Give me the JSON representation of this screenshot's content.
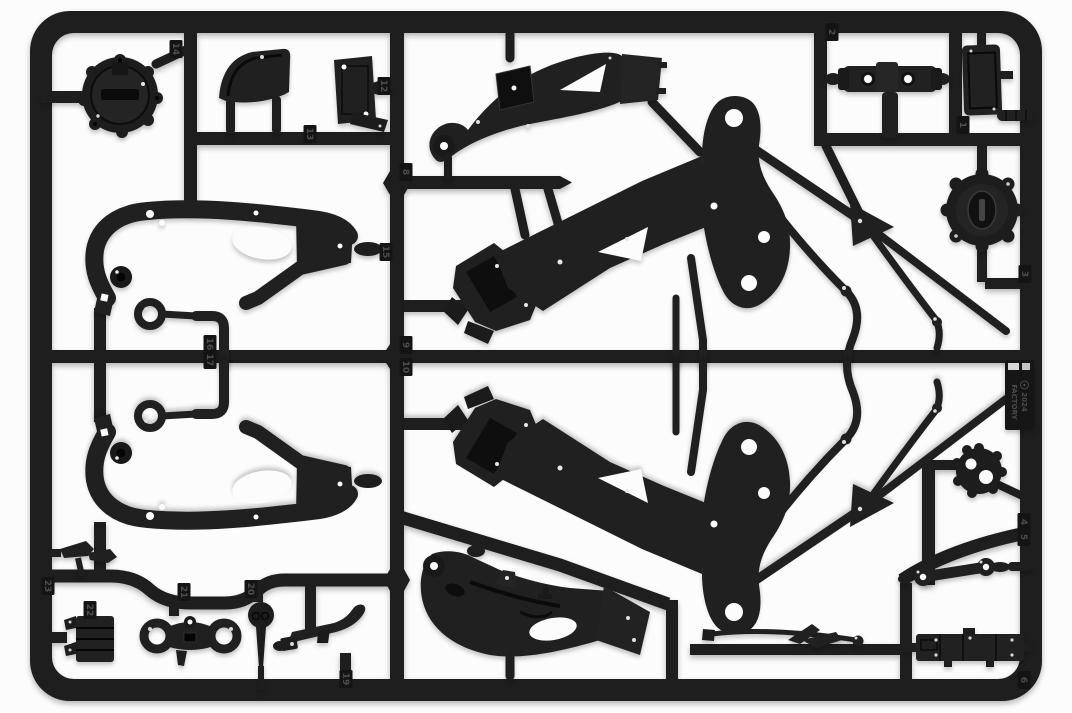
{
  "scene": {
    "type": "photograph",
    "subject": "Black injection-molded plastic model-kit sprue with motorcycle frame parts",
    "background_color": "#fcfcfc",
    "plastic_color": "#1e1e1e",
    "plastic_dark": "#0c0c0c",
    "plastic_highlight": "#3a3a3a"
  },
  "mold_tag": {
    "year": "2024",
    "brand": "FACTORY",
    "logo": "circled-monogram"
  },
  "gate_numbers": [
    {
      "label": "14",
      "x": 176,
      "y": 49
    },
    {
      "label": "13",
      "x": 310,
      "y": 134
    },
    {
      "label": "12",
      "x": 384,
      "y": 86
    },
    {
      "label": "2",
      "x": 832,
      "y": 32
    },
    {
      "label": "1",
      "x": 963,
      "y": 125
    },
    {
      "label": "8",
      "x": 406,
      "y": 172
    },
    {
      "label": "15",
      "x": 386,
      "y": 252
    },
    {
      "label": "3",
      "x": 1025,
      "y": 274
    },
    {
      "label": "9",
      "x": 406,
      "y": 345
    },
    {
      "label": "10",
      "x": 406,
      "y": 367
    },
    {
      "label": "16",
      "x": 210,
      "y": 344
    },
    {
      "label": "17",
      "x": 210,
      "y": 360
    },
    {
      "label": "4",
      "x": 1024,
      "y": 522
    },
    {
      "label": "5",
      "x": 1024,
      "y": 537
    },
    {
      "label": "6",
      "x": 1024,
      "y": 680
    },
    {
      "label": "23",
      "x": 48,
      "y": 586
    },
    {
      "label": "22",
      "x": 90,
      "y": 610
    },
    {
      "label": "21",
      "x": 184,
      "y": 592
    },
    {
      "label": "20",
      "x": 251,
      "y": 589
    },
    {
      "label": "19",
      "x": 346,
      "y": 679
    }
  ],
  "parts": [
    {
      "name": "clutch-cover",
      "desc": "round clutch engine cover"
    },
    {
      "name": "front-fender-bracket",
      "desc": "curved bracket"
    },
    {
      "name": "mount-plate",
      "desc": "flat mounting plate"
    },
    {
      "name": "upper-side-panel",
      "desc": "swingarm side panel"
    },
    {
      "name": "handlebar-tee",
      "desc": "T-shaped bracket"
    },
    {
      "name": "radiator-panel",
      "desc": "small radiator panel"
    },
    {
      "name": "hose-cylinder",
      "desc": "small cylinder"
    },
    {
      "name": "ignition-cover",
      "desc": "round ignition cover"
    },
    {
      "name": "frame-side-upper",
      "desc": "frame side plate"
    },
    {
      "name": "frame-side-lower",
      "desc": "mirrored frame side plate"
    },
    {
      "name": "tube-loop-upper",
      "desc": "bent tube with eyelet"
    },
    {
      "name": "tube-loop-lower",
      "desc": "mirrored bent tube with eyelet"
    },
    {
      "name": "main-frame-upper",
      "desc": "motorcycle main frame half"
    },
    {
      "name": "main-frame-lower",
      "desc": "mirrored main frame half"
    },
    {
      "name": "belly-pan",
      "desc": "curved lower cowl"
    },
    {
      "name": "winglet-blades",
      "desc": "small aero blades"
    },
    {
      "name": "ribbed-canister",
      "desc": "ribbed canister"
    },
    {
      "name": "triple-clamp",
      "desc": "fork triple clamp"
    },
    {
      "name": "roller-disc",
      "desc": "small roller disc"
    },
    {
      "name": "side-stand",
      "desc": "side stand lever"
    },
    {
      "name": "sprocket-cover",
      "desc": "small round cover"
    },
    {
      "name": "suspension-link",
      "desc": "linkage bone"
    },
    {
      "name": "battery-box",
      "desc": "rectangular box part"
    },
    {
      "name": "push-rod",
      "desc": "thin rod"
    },
    {
      "name": "aero-blade-right",
      "desc": "small blade"
    }
  ]
}
